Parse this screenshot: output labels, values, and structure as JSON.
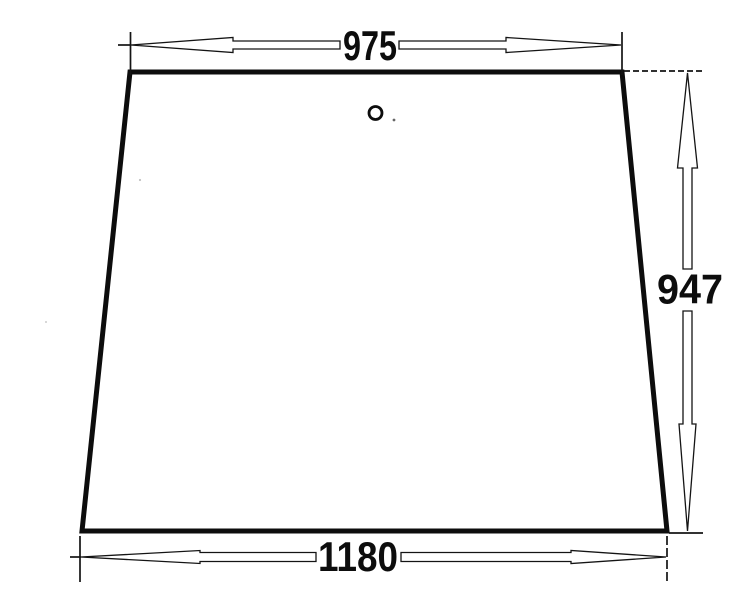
{
  "drawing": {
    "type": "technical-dimension-drawing",
    "subject": "trapezoidal glass panel with small mounting hole near top center",
    "colors": {
      "background": "#ffffff",
      "ink": "#0d0d0d"
    },
    "dimensions": {
      "top": {
        "label": "975",
        "value": 975
      },
      "bottom": {
        "label": "1180",
        "value": 1180
      },
      "right": {
        "label": "947",
        "value": 947
      }
    }
  }
}
